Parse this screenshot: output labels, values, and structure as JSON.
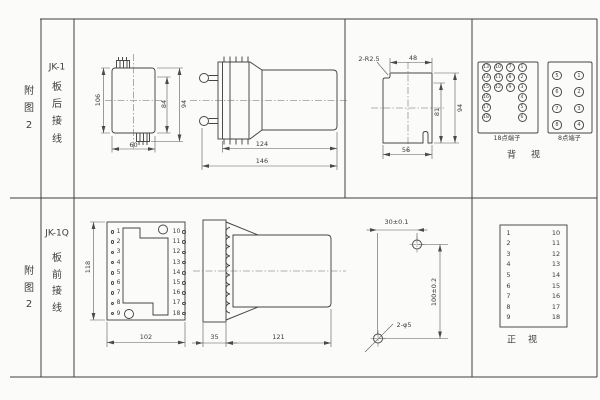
{
  "row1": {
    "figure": [
      "附",
      "图",
      "2"
    ],
    "model": "JK-1",
    "wiring": [
      "板",
      "后",
      "接",
      "线"
    ],
    "front_view": {
      "height": "106",
      "body_height": "84",
      "overall_height": "94",
      "width": "60"
    },
    "side_view": {
      "body_length": "124",
      "total_length": "146"
    },
    "cutout": {
      "corner_radius": "2-R2.5",
      "top_width": "48",
      "inner_height": "81",
      "height": "94",
      "width": "56"
    },
    "terminals18": {
      "label": "18点端子",
      "col1": [
        "13",
        "14",
        "15",
        "16",
        "17",
        "18"
      ],
      "col2": [
        "10",
        "11",
        "12"
      ],
      "col3": [
        "7",
        "8",
        "9"
      ],
      "col4": [
        "1",
        "2",
        "3",
        "4",
        "5",
        "6"
      ]
    },
    "terminals8": {
      "label": "8点端子",
      "left": [
        "5",
        "6",
        "7",
        "8"
      ],
      "right": [
        "1",
        "2",
        "3",
        "4"
      ]
    },
    "view_label": [
      "背",
      "视"
    ]
  },
  "row2": {
    "figure": [
      "附",
      "图",
      "2"
    ],
    "model": "JK-1Q",
    "wiring": [
      "板",
      "前",
      "接",
      "线"
    ],
    "front_view": {
      "height": "118",
      "width": "102",
      "left_terminals": [
        "1",
        "2",
        "3",
        "4",
        "5",
        "6",
        "7",
        "8",
        "9"
      ],
      "right_terminals": [
        "10",
        "11",
        "12",
        "13",
        "14",
        "15",
        "16",
        "17",
        "18"
      ]
    },
    "side_view": {
      "plate": "35",
      "body_length": "121"
    },
    "drilling": {
      "hole_spacing_h": "30±0.1",
      "hole_spacing_v": "100±0.2",
      "hole_label": "2-φ5"
    },
    "terminal_map": {
      "left": [
        "1",
        "2",
        "3",
        "4",
        "5",
        "6",
        "7",
        "8",
        "9"
      ],
      "right": [
        "10",
        "11",
        "12",
        "13",
        "14",
        "15",
        "16",
        "17",
        "18"
      ],
      "view_label": [
        "正",
        "视"
      ]
    }
  }
}
